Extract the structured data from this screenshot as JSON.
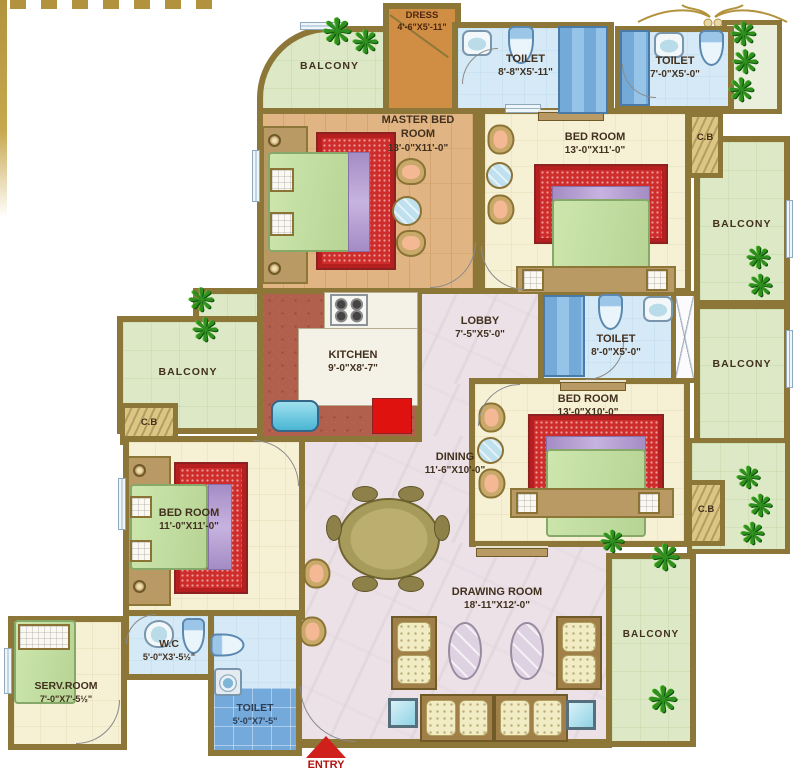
{
  "plan_title": "4 BHK Apartment Floor Plan",
  "colors": {
    "wall": "#8d7738",
    "balcony_green": "#dce8c6",
    "floor_cream": "#f6f1d5",
    "wood": "#e1b583",
    "kitchen_tile": "#b2604e",
    "marble": "#ebe1e7",
    "toilet_blue": "#d5eaf6",
    "carpet_red": "#cf2c2c",
    "entry_red": "#d0201c",
    "gold": "#b2923c"
  },
  "rooms": [
    {
      "id": "dress",
      "name": "DRESS",
      "dims": "4'-6\"X5'-11\""
    },
    {
      "id": "toilet-top",
      "name": "TOILET",
      "dims": "8'-8\"X5'-11\""
    },
    {
      "id": "toilet-top-right",
      "name": "TOILET",
      "dims": "7'-0\"X5'-0\""
    },
    {
      "id": "balcony-top-left",
      "name": "BALCONY",
      "dims": ""
    },
    {
      "id": "master-bedroom",
      "name": "MASTER BED ROOM",
      "dims": "13'-0\"X11'-0\""
    },
    {
      "id": "bedroom-top-right",
      "name": "BED ROOM",
      "dims": "13'-0\"X11'-0\""
    },
    {
      "id": "cupboard-top-right",
      "name": "C.B",
      "dims": ""
    },
    {
      "id": "balcony-right-upper",
      "name": "BALCONY",
      "dims": ""
    },
    {
      "id": "kitchen",
      "name": "KITCHEN",
      "dims": "9'-0\"X8'-7\""
    },
    {
      "id": "lobby",
      "name": "LOBBY",
      "dims": "7'-5\"X5'-0\""
    },
    {
      "id": "toilet-middle",
      "name": "TOILET",
      "dims": "8'-0\"X5'-0\""
    },
    {
      "id": "balcony-right-lower",
      "name": "BALCONY",
      "dims": ""
    },
    {
      "id": "bedroom-right",
      "name": "BED ROOM",
      "dims": "13'-0\"X10'-0\""
    },
    {
      "id": "cupboard-right",
      "name": "C.B",
      "dims": ""
    },
    {
      "id": "balcony-left",
      "name": "BALCONY",
      "dims": ""
    },
    {
      "id": "cupboard-left",
      "name": "C.B",
      "dims": ""
    },
    {
      "id": "bedroom-left",
      "name": "BED ROOM",
      "dims": "11'-0\"X11'-0\""
    },
    {
      "id": "dining",
      "name": "DINING",
      "dims": "11'-6\"X10'-0\""
    },
    {
      "id": "drawing-room",
      "name": "DRAWING ROOM",
      "dims": "18'-11\"X12'-0\""
    },
    {
      "id": "balcony-bottom-right",
      "name": "BALCONY",
      "dims": ""
    },
    {
      "id": "wc",
      "name": "W.C",
      "dims": "5'-0\"X3'-5½\""
    },
    {
      "id": "serv-room",
      "name": "SERV.ROOM",
      "dims": "7'-0\"X7'-5½\""
    },
    {
      "id": "toilet-bottom",
      "name": "TOILET",
      "dims": "5'-0\"X7'-5\""
    }
  ],
  "entry": {
    "label": "ENTRY"
  }
}
